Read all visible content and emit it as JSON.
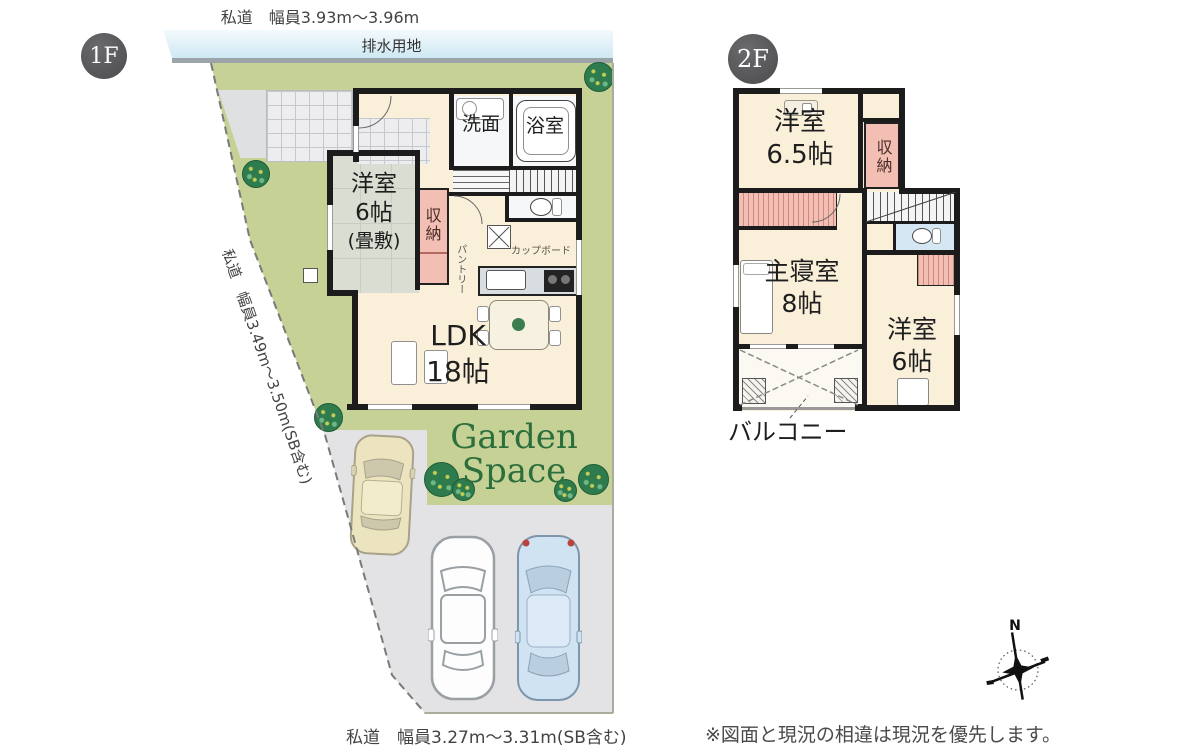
{
  "site": {
    "top_road": "私道　幅員3.93m〜3.96m",
    "drainage": "排水用地",
    "left_road": "私道　幅員3.49m〜3.50m(SB含む)",
    "bottom_road": "私道　幅員3.27m〜3.31m(SB含む)",
    "garden_line1": "Garden",
    "garden_line2": "Space"
  },
  "floor1": {
    "badge": "1F",
    "rooms": {
      "washroom": "洗面",
      "bath": "浴室",
      "western_l1": "洋室",
      "western_l2": "6帖",
      "western_l3": "(畳敷)",
      "closet": "収納",
      "pantry": "パントリー",
      "cupboard": "カップボード",
      "ldk_l1": "LDK",
      "ldk_l2": "18帖"
    }
  },
  "floor2": {
    "badge": "2F",
    "rooms": {
      "western65_l1": "洋室",
      "western65_l2": "6.5帖",
      "closet": "収納",
      "master_l1": "主寝室",
      "master_l2": "8帖",
      "western6_l1": "洋室",
      "western6_l2": "6帖",
      "balcony": "バルコニー"
    }
  },
  "note": {
    "disclaimer": "※図面と現況の相違は現況を優先します。"
  },
  "compass": {
    "north": "N"
  },
  "colors": {
    "siteGreen": "#c6d295",
    "roadGray": "#e3e3e5",
    "roomCream": "#faf0da",
    "closetPink": "#f3beb3",
    "tatamiGray": "#d9ddd2",
    "toiletBlue": "#d5e7f2",
    "gardenGreen": "#2c6e3c",
    "wallBlack": "#1c1c1c",
    "badgeGray": "#4c4c4f"
  }
}
